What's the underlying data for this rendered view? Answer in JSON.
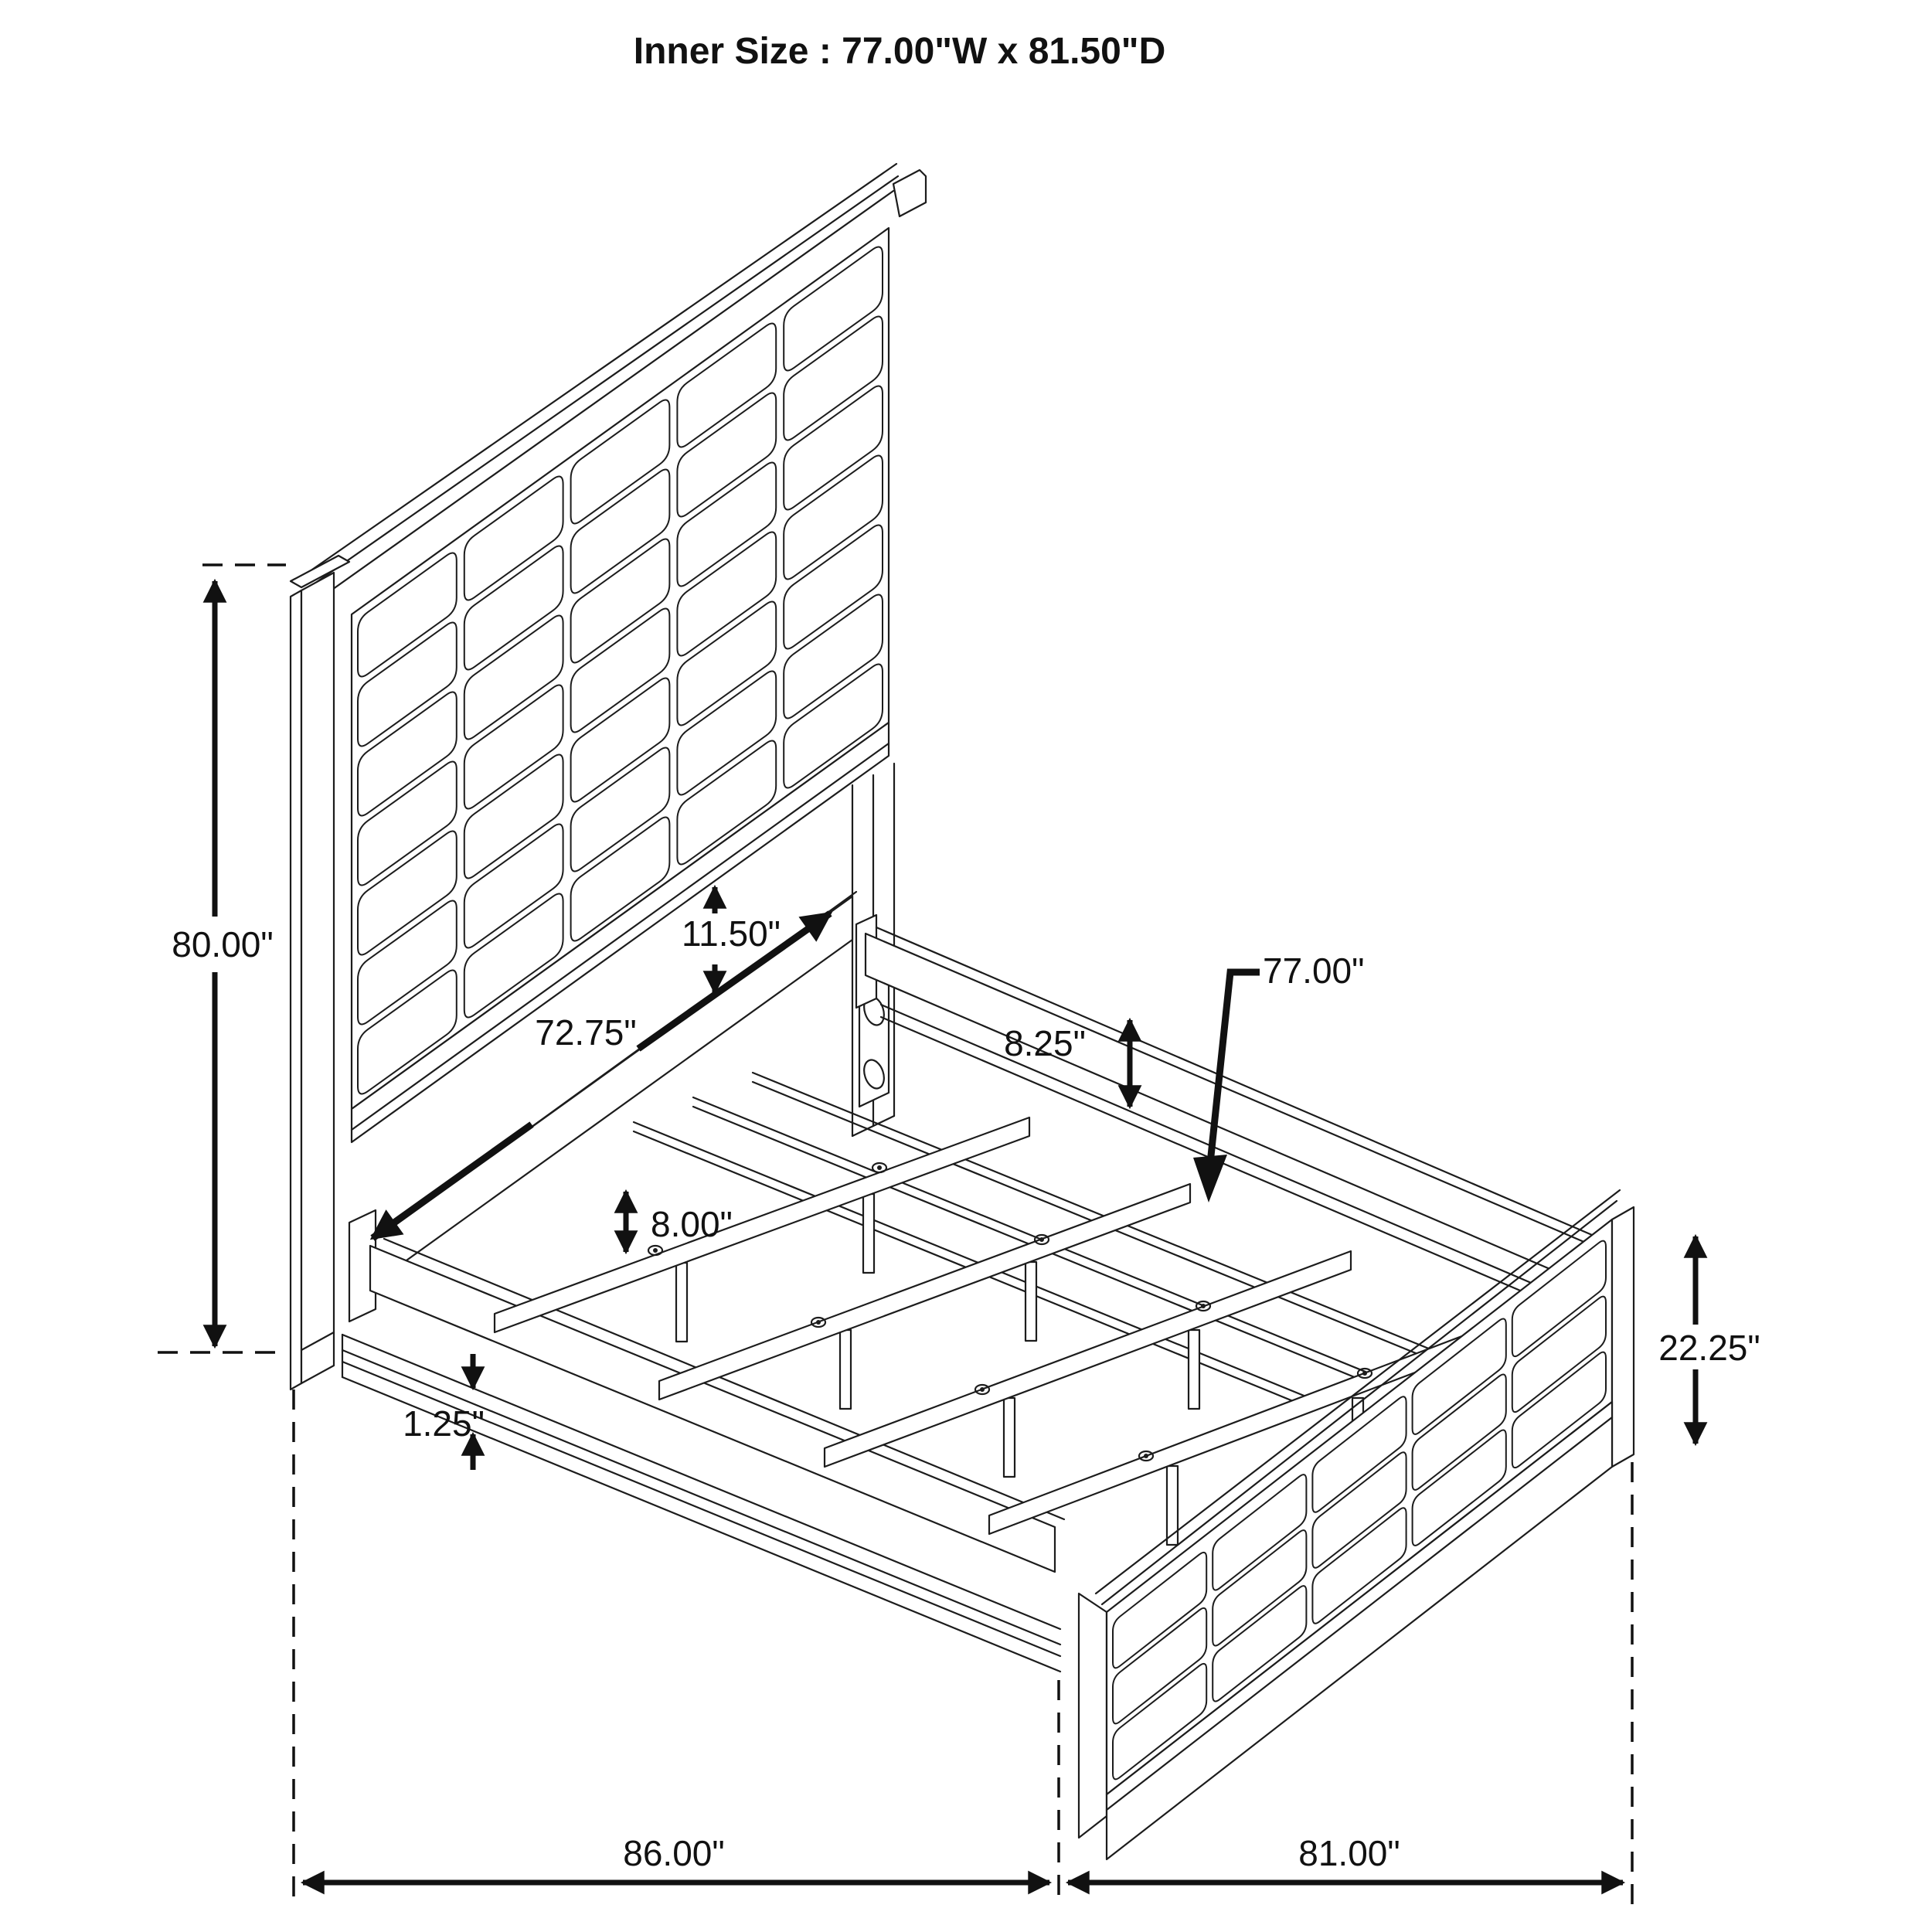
{
  "title": "Inner Size : 77.00\"W x 81.50\"D",
  "dims": {
    "headboard_height": "80.00\"",
    "panel_to_rail_gap": "11.50\"",
    "side_rail_length": "72.75\"",
    "rail_to_slat_height": "8.25\"",
    "slat_length": "77.00\"",
    "slat_leg_height": "8.00\"",
    "base_lip_thickness": "1.25\"",
    "footboard_height": "22.25\"",
    "overall_length": "86.00\"",
    "overall_width": "81.00\""
  },
  "colors": {
    "line": "#1c1c1c",
    "background": "#ffffff"
  }
}
